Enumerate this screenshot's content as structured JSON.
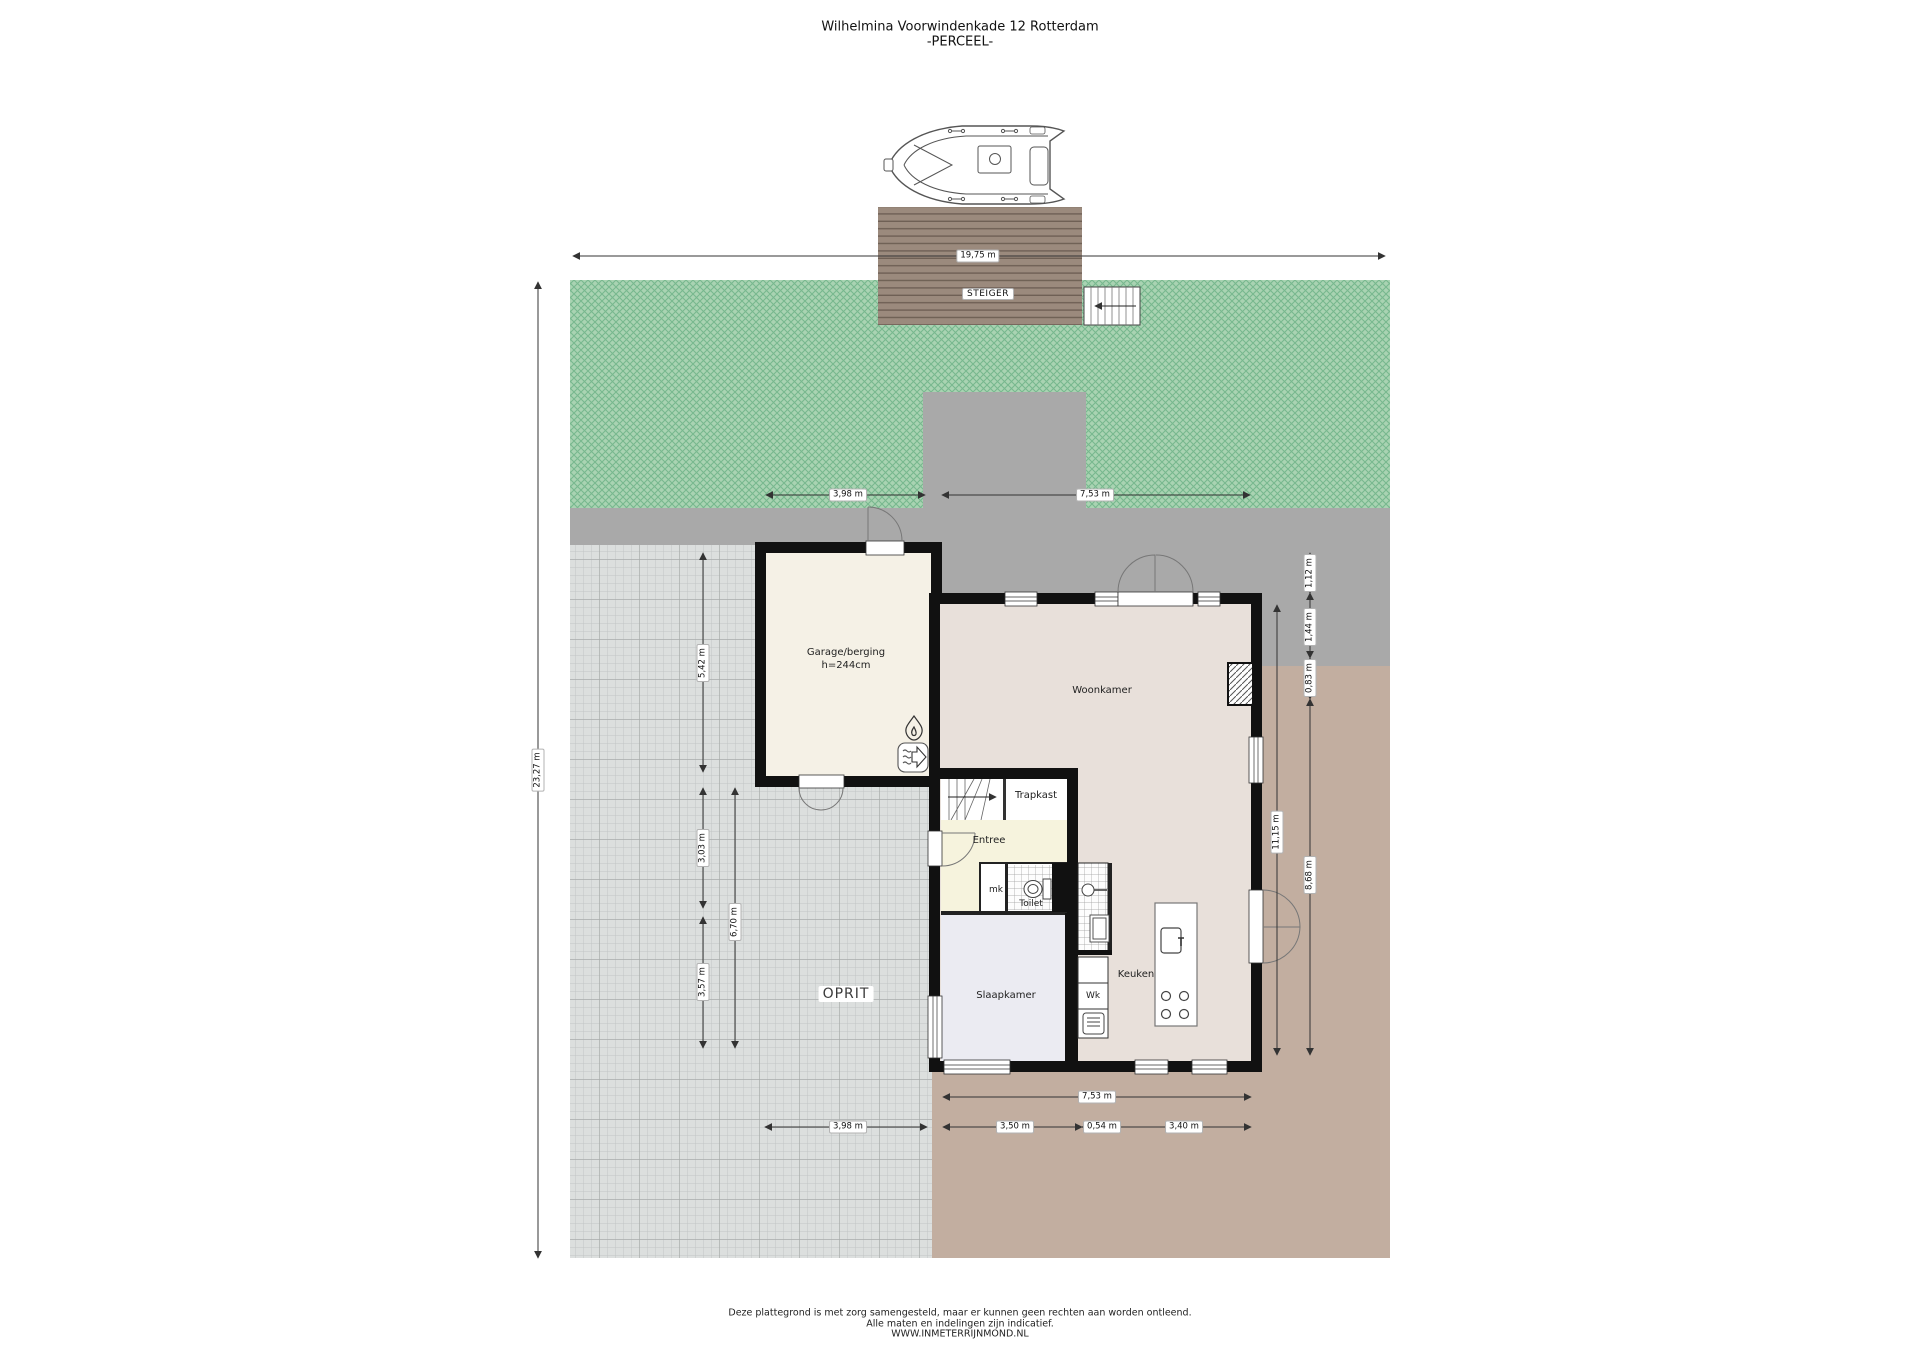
{
  "title": {
    "line1": "Wilhelmina Voorwindenkade 12 Rotterdam",
    "line2": "-PERCEEL-"
  },
  "area_labels": {
    "steiger": "STEIGER",
    "oprit": "OPRIT"
  },
  "rooms": {
    "garage": "Garage/berging",
    "garage_height": "h=244cm",
    "woonkamer": "Woonkamer",
    "trapkast": "Trapkast",
    "entree": "Entree",
    "mk": "mk",
    "toilet": "Toilet",
    "slaapkamer": "Slaapkamer",
    "keuken": "Keuken",
    "wk": "Wk"
  },
  "dims": {
    "total_width": "19,75 m",
    "total_height": "23,27 m",
    "top_left": "3,98 m",
    "top_right": "7,53 m",
    "left_garage": "5,42 m",
    "left_mid": "3,03 m",
    "left_low": "3,57 m",
    "left_sum": "6,70 m",
    "right_1": "1,12 m",
    "right_2": "1,44 m",
    "right_3": "0,83 m",
    "right_sum": "8,68 m",
    "right_total": "11,15 m",
    "bottom_total": "7,53 m",
    "bottom_left": "3,98 m",
    "bottom_1": "3,50 m",
    "bottom_2": "0,54 m",
    "bottom_3": "3,40 m"
  },
  "footer": {
    "line1": "Deze plattegrond is met zorg samengesteld, maar er kunnen geen rechten aan worden ontleend.",
    "line2": "Alle maten en indelingen zijn indicatief.",
    "line3": "WWW.INMETERRIJNMOND.NL"
  },
  "colors": {
    "grass": "#a9d3b2",
    "grass_hatch": "#77b88e",
    "pavement_gray": "#a9a9a9",
    "terrace_tan": "#c2aea0",
    "oprit_tile": "#dcdfde",
    "dock_brown": "#9b8a7d",
    "wall_black": "#111111",
    "garage_floor": "#f5f1e6",
    "living_floor": "#e8e0da",
    "entry_floor": "#f6f3dd",
    "bedroom_floor": "#ebebf2"
  }
}
